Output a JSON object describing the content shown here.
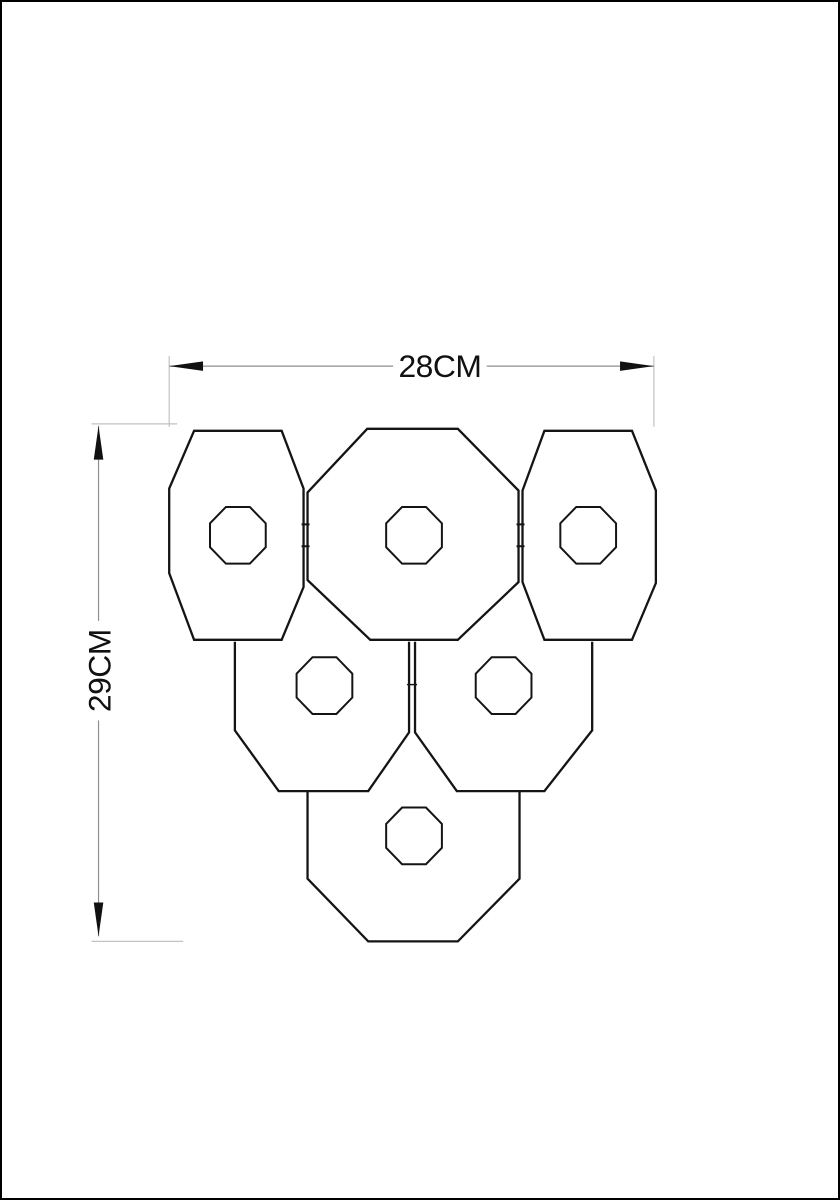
{
  "page": {
    "background": "#ffffff",
    "border_color": "#000000"
  },
  "dimensions": {
    "width_label": "28CM",
    "height_label": "29CM"
  },
  "colors": {
    "outline": "#141414",
    "dimension_line": "#8f8f8f",
    "extension_line": "#c2c2c2",
    "arrow": "#111111",
    "label_text": "#111111"
  },
  "fixture": {
    "shade_count": 6,
    "shades": [
      "top-left",
      "top-center",
      "top-right",
      "middle-left",
      "middle-right",
      "bottom"
    ]
  }
}
